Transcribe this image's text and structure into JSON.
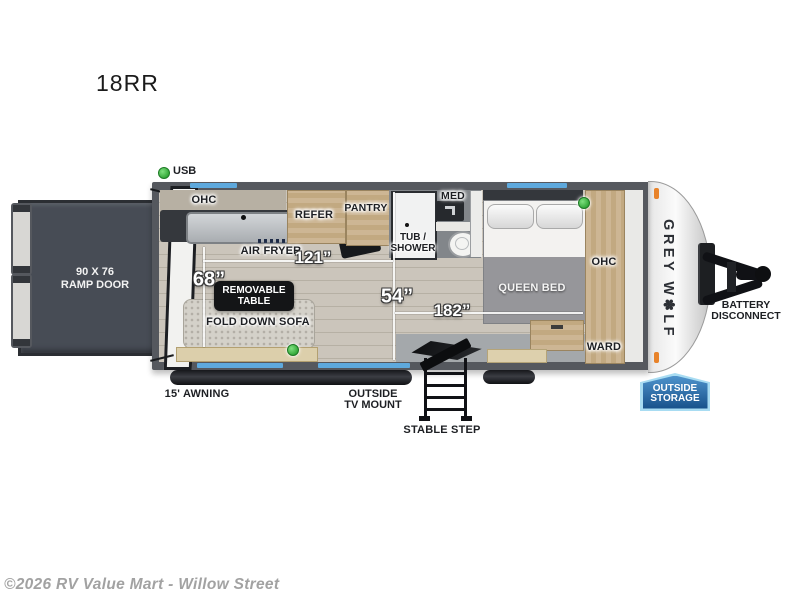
{
  "page": {
    "model": "18RR",
    "copyright": "©2026 RV Value Mart - Willow Street"
  },
  "brand": {
    "logo_text": "GREY W✽LF"
  },
  "callouts": {
    "usb": "USB",
    "ramp_door_line1": "90 X 76",
    "ramp_door_line2": "RAMP DOOR",
    "awning": "15' AWNING",
    "tv_mount_line1": "OUTSIDE",
    "tv_mount_line2": "TV MOUNT",
    "stable_step": "STABLE STEP",
    "battery_line1": "BATTERY",
    "battery_line2": "DISCONNECT",
    "outside_storage_line1": "OUTSIDE",
    "outside_storage_line2": "STORAGE"
  },
  "rooms": {
    "ohc_kitchen": "OHC",
    "refer": "REFER",
    "pantry": "PANTRY",
    "air_fryer": "AIR FRYER",
    "med": "MED",
    "tub_shower_line1": "TUB /",
    "tub_shower_line2": "SHOWER",
    "queen_bed": "QUEEN BED",
    "ohc_bedroom": "OHC",
    "ward": "WARD",
    "removable_table_line1": "REMOVABLE",
    "removable_table_line2": "TABLE",
    "fold_down_sofa": "FOLD DOWN SOFA"
  },
  "dimensions": {
    "d121": "121”",
    "d68": "68”",
    "d54": "54”",
    "d182": "182”"
  },
  "colors": {
    "window_blue": "#5ea9dd",
    "wall_gray": "#55585e",
    "wood": "#c8b192",
    "led_green": "#35a93a",
    "clearance_orange": "#e8832a",
    "storage_badge_blue": "#2a6da8"
  }
}
